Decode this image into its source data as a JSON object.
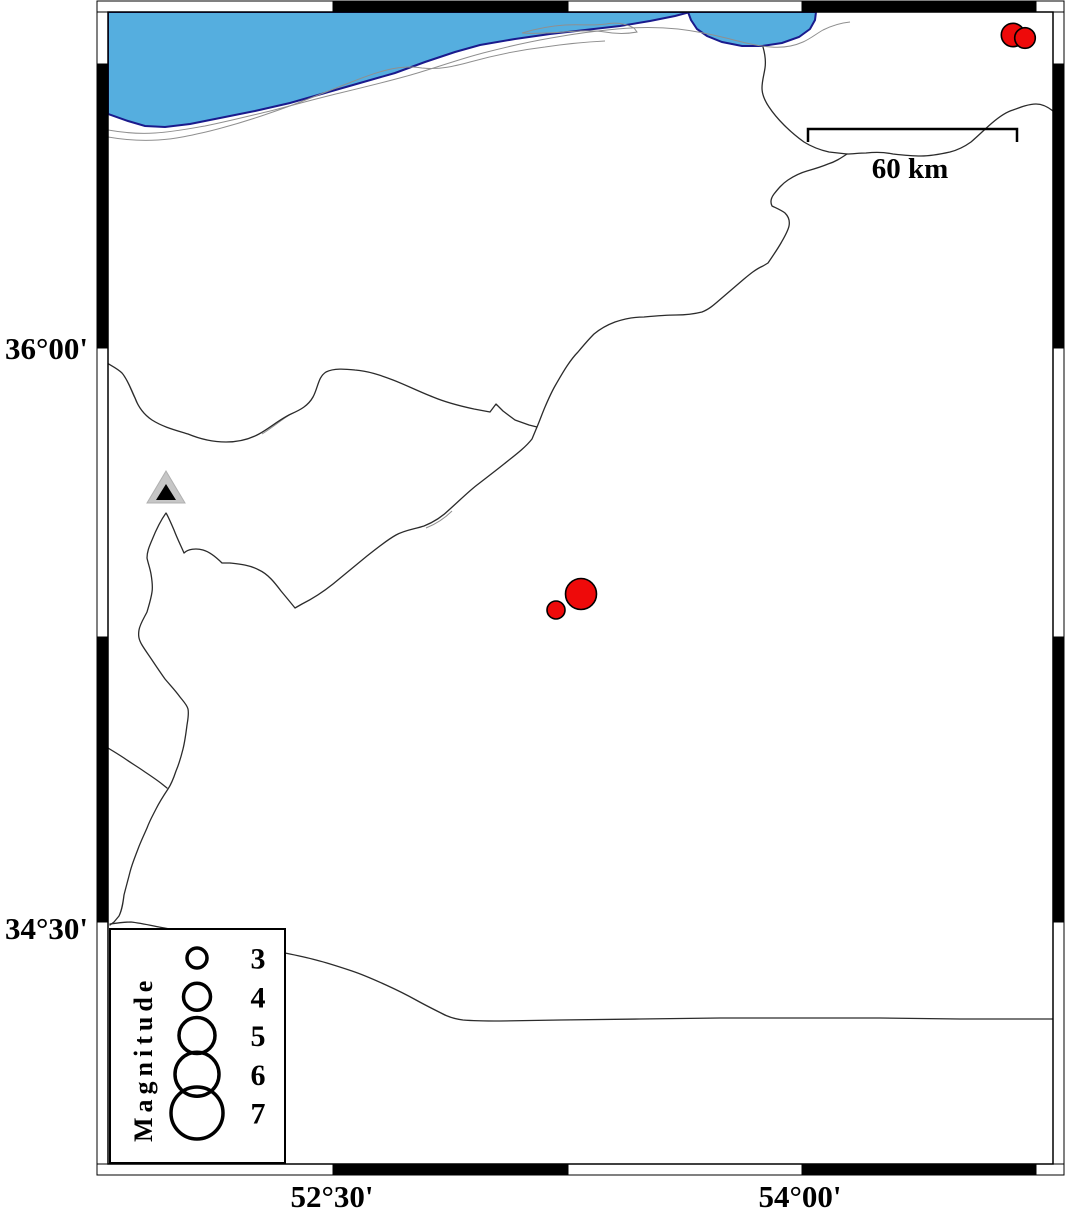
{
  "map": {
    "y_axis_labels": [
      {
        "text": "36°00'",
        "y": 348
      },
      {
        "text": "34°30'",
        "y": 928
      }
    ],
    "x_axis_labels": [
      {
        "text": "52°30'",
        "x": 332
      },
      {
        "text": "54°00'",
        "x": 800
      }
    ],
    "scale_bar": {
      "label": "60 km",
      "length_km": 60
    },
    "legend": {
      "title": "Magnitude",
      "entries": [
        {
          "label": "3",
          "r": 10
        },
        {
          "label": "4",
          "r": 13.5
        },
        {
          "label": "5",
          "r": 18
        },
        {
          "label": "6",
          "r": 22
        },
        {
          "label": "7",
          "r": 26
        }
      ]
    },
    "colors": {
      "sea": "#55AEDF",
      "sea_outline": "#1A1A8C",
      "quake_fill": "#EE0A0A",
      "quake_outline": "#000000",
      "triangle_fill": "#C6C6C6",
      "triangle_inner": "#000000",
      "boundary": "#2b2b2b",
      "shoreline_gray": "#8f8f8f"
    }
  },
  "chart_data": {
    "type": "map",
    "title": "",
    "region": {
      "lon_min": 51.78,
      "lon_max": 54.8,
      "lat_min": 33.87,
      "lat_max": 36.89
    },
    "x_ticks": [
      "52°30'",
      "54°00'"
    ],
    "y_ticks": [
      "36°00'",
      "34°30'"
    ],
    "scale_bar_km": 60,
    "legend_magnitudes": [
      3,
      4,
      5,
      6,
      7
    ],
    "earthquakes": [
      {
        "lon": 53.29,
        "lat": 35.36,
        "magnitude": 4.4,
        "x": 581,
        "y": 594,
        "r": 15.5
      },
      {
        "lon": 53.21,
        "lat": 35.32,
        "magnitude": 3.0,
        "x": 556,
        "y": 610,
        "r": 9
      },
      {
        "lon": 54.67,
        "lat": 36.83,
        "magnitude": 3.4,
        "x": 1013,
        "y": 35,
        "r": 11.7
      },
      {
        "lon": 54.71,
        "lat": 36.82,
        "magnitude": 3.1,
        "x": 1025,
        "y": 38,
        "r": 10.3
      }
    ],
    "station_triangle": {
      "lon": 51.97,
      "lat": 35.63,
      "x": 166,
      "y": 490
    },
    "features": [
      "Caspian Sea coast (top)",
      "Gorgan Bay",
      "province boundary lines"
    ]
  }
}
